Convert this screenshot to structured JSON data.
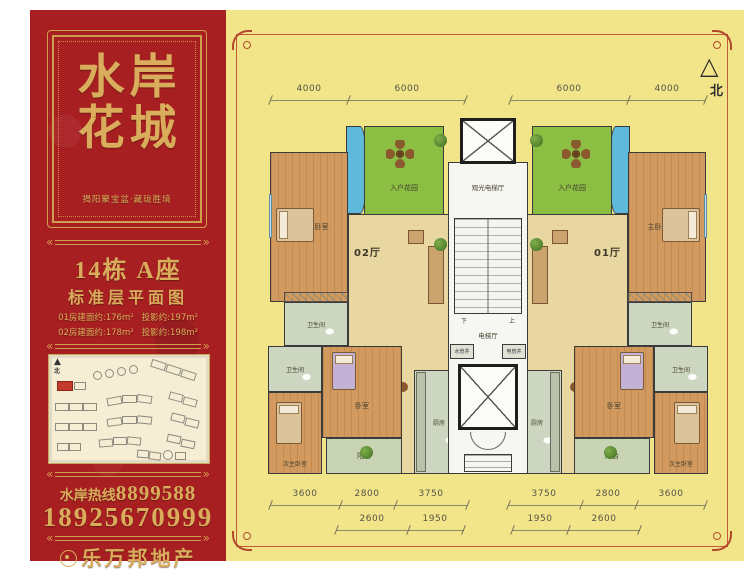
{
  "panel": {
    "title_line1": "水岸",
    "title_line2": "花城",
    "subtitle": "揭阳聚宝盆·藏珑胜境",
    "building": "14栋 A座",
    "plan_type": "标准层平面图",
    "area1_left": "01房建面约:176m²",
    "area1_right": "投影约:197m²",
    "area2_left": "02房建面约:178m²",
    "area2_right": "投影约:198m²",
    "hotline_label": "水岸热线",
    "hotline_number1": "8899588",
    "hotline_number2": "18925670999",
    "agency": "乐万邦地产",
    "colors": {
      "panel_bg": "#a81f22",
      "gold": "#d9ad5c"
    }
  },
  "sitemap": {
    "north": "北"
  },
  "plan": {
    "north": "北",
    "colors": {
      "page_bg": "#f2e489",
      "wood": "#d29a5e",
      "open": "#e9d7a1",
      "bath": "#ccd6c1",
      "garden": "#8cbe43",
      "water": "#5fb9da",
      "wall": "#3b3b3b"
    },
    "labels": {
      "garden_left": "入户花园",
      "garden_right": "入户花园",
      "master_left": "主卧室",
      "master_right": "主卧室",
      "bath1_left": "卫生间",
      "bath2_left": "卫生间",
      "bath1_right": "卫生间",
      "bath2_right": "卫生间",
      "living_left": "02厅",
      "living_right": "01厅",
      "dining_left": "餐厅",
      "dining_right": "餐厅",
      "bedroom_left": "卧室",
      "bedroom_right": "卧室",
      "balcony_left": "阳台",
      "balcony_right": "阳台",
      "secmaster_left": "次主卧室",
      "secmaster_right": "次主卧室",
      "kitchen_left": "厨房",
      "kitchen_right": "厨房",
      "hall_top": "观光电梯厅",
      "hall_bottom": "电梯厅",
      "shaft_left": "水管井",
      "shaft_right": "电管井",
      "up": "上",
      "down": "下"
    },
    "dims": {
      "top_left": [
        "4000",
        "6000"
      ],
      "top_right": [
        "6000",
        "4000"
      ],
      "bottom_left": [
        "3600",
        "2800",
        "3750"
      ],
      "bottom_right": [
        "3750",
        "2800",
        "3600"
      ],
      "bottom2_left": [
        "2600",
        "1950"
      ],
      "bottom2_right": [
        "1950",
        "2600"
      ]
    }
  }
}
